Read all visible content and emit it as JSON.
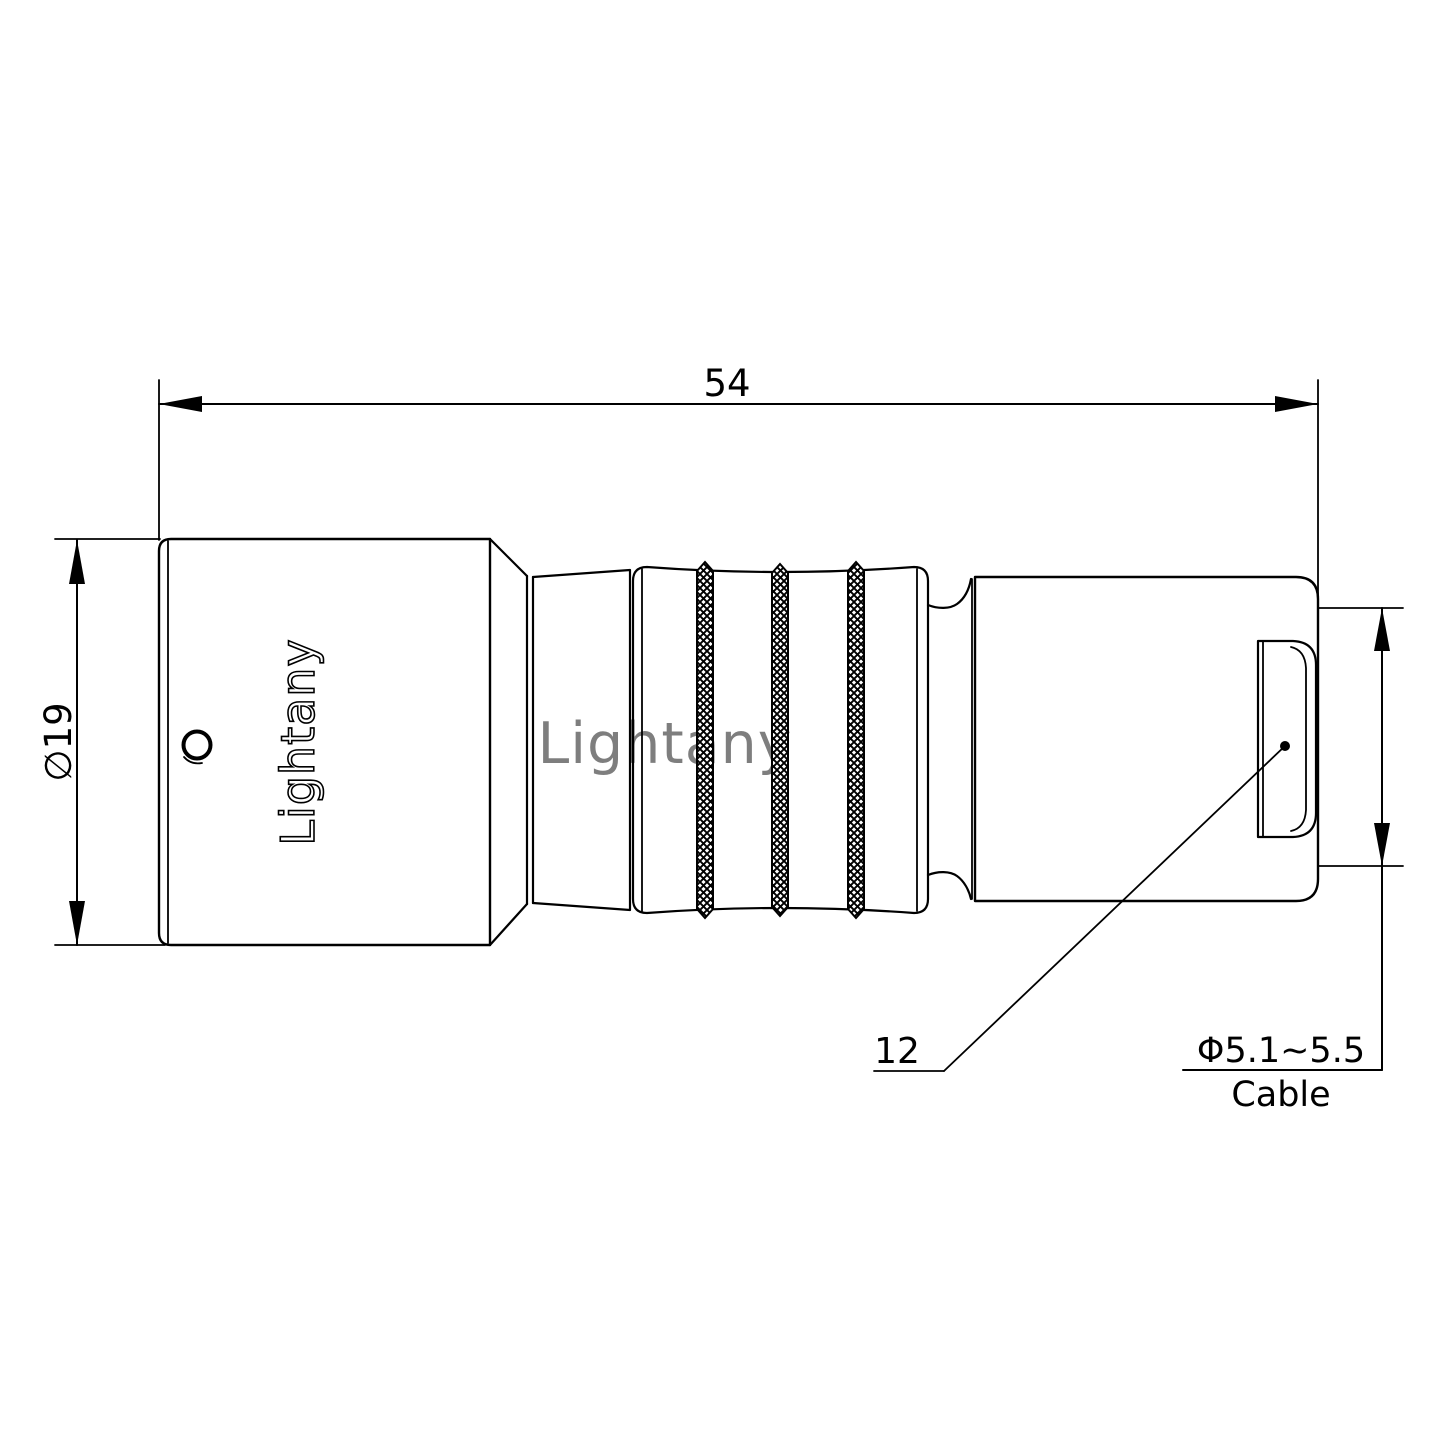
{
  "drawing": {
    "watermark_text": "Lightany",
    "engraving_text": "Lightany",
    "dimensions": {
      "overall_length": "54",
      "front_diameter": "∅19",
      "rear_size": "12",
      "cable_diameter": "Φ5.1~5.5",
      "cable_label": "Cable"
    },
    "colors": {
      "line": "#000000",
      "watermark": "#e9a2a2",
      "background": "#ffffff"
    }
  }
}
